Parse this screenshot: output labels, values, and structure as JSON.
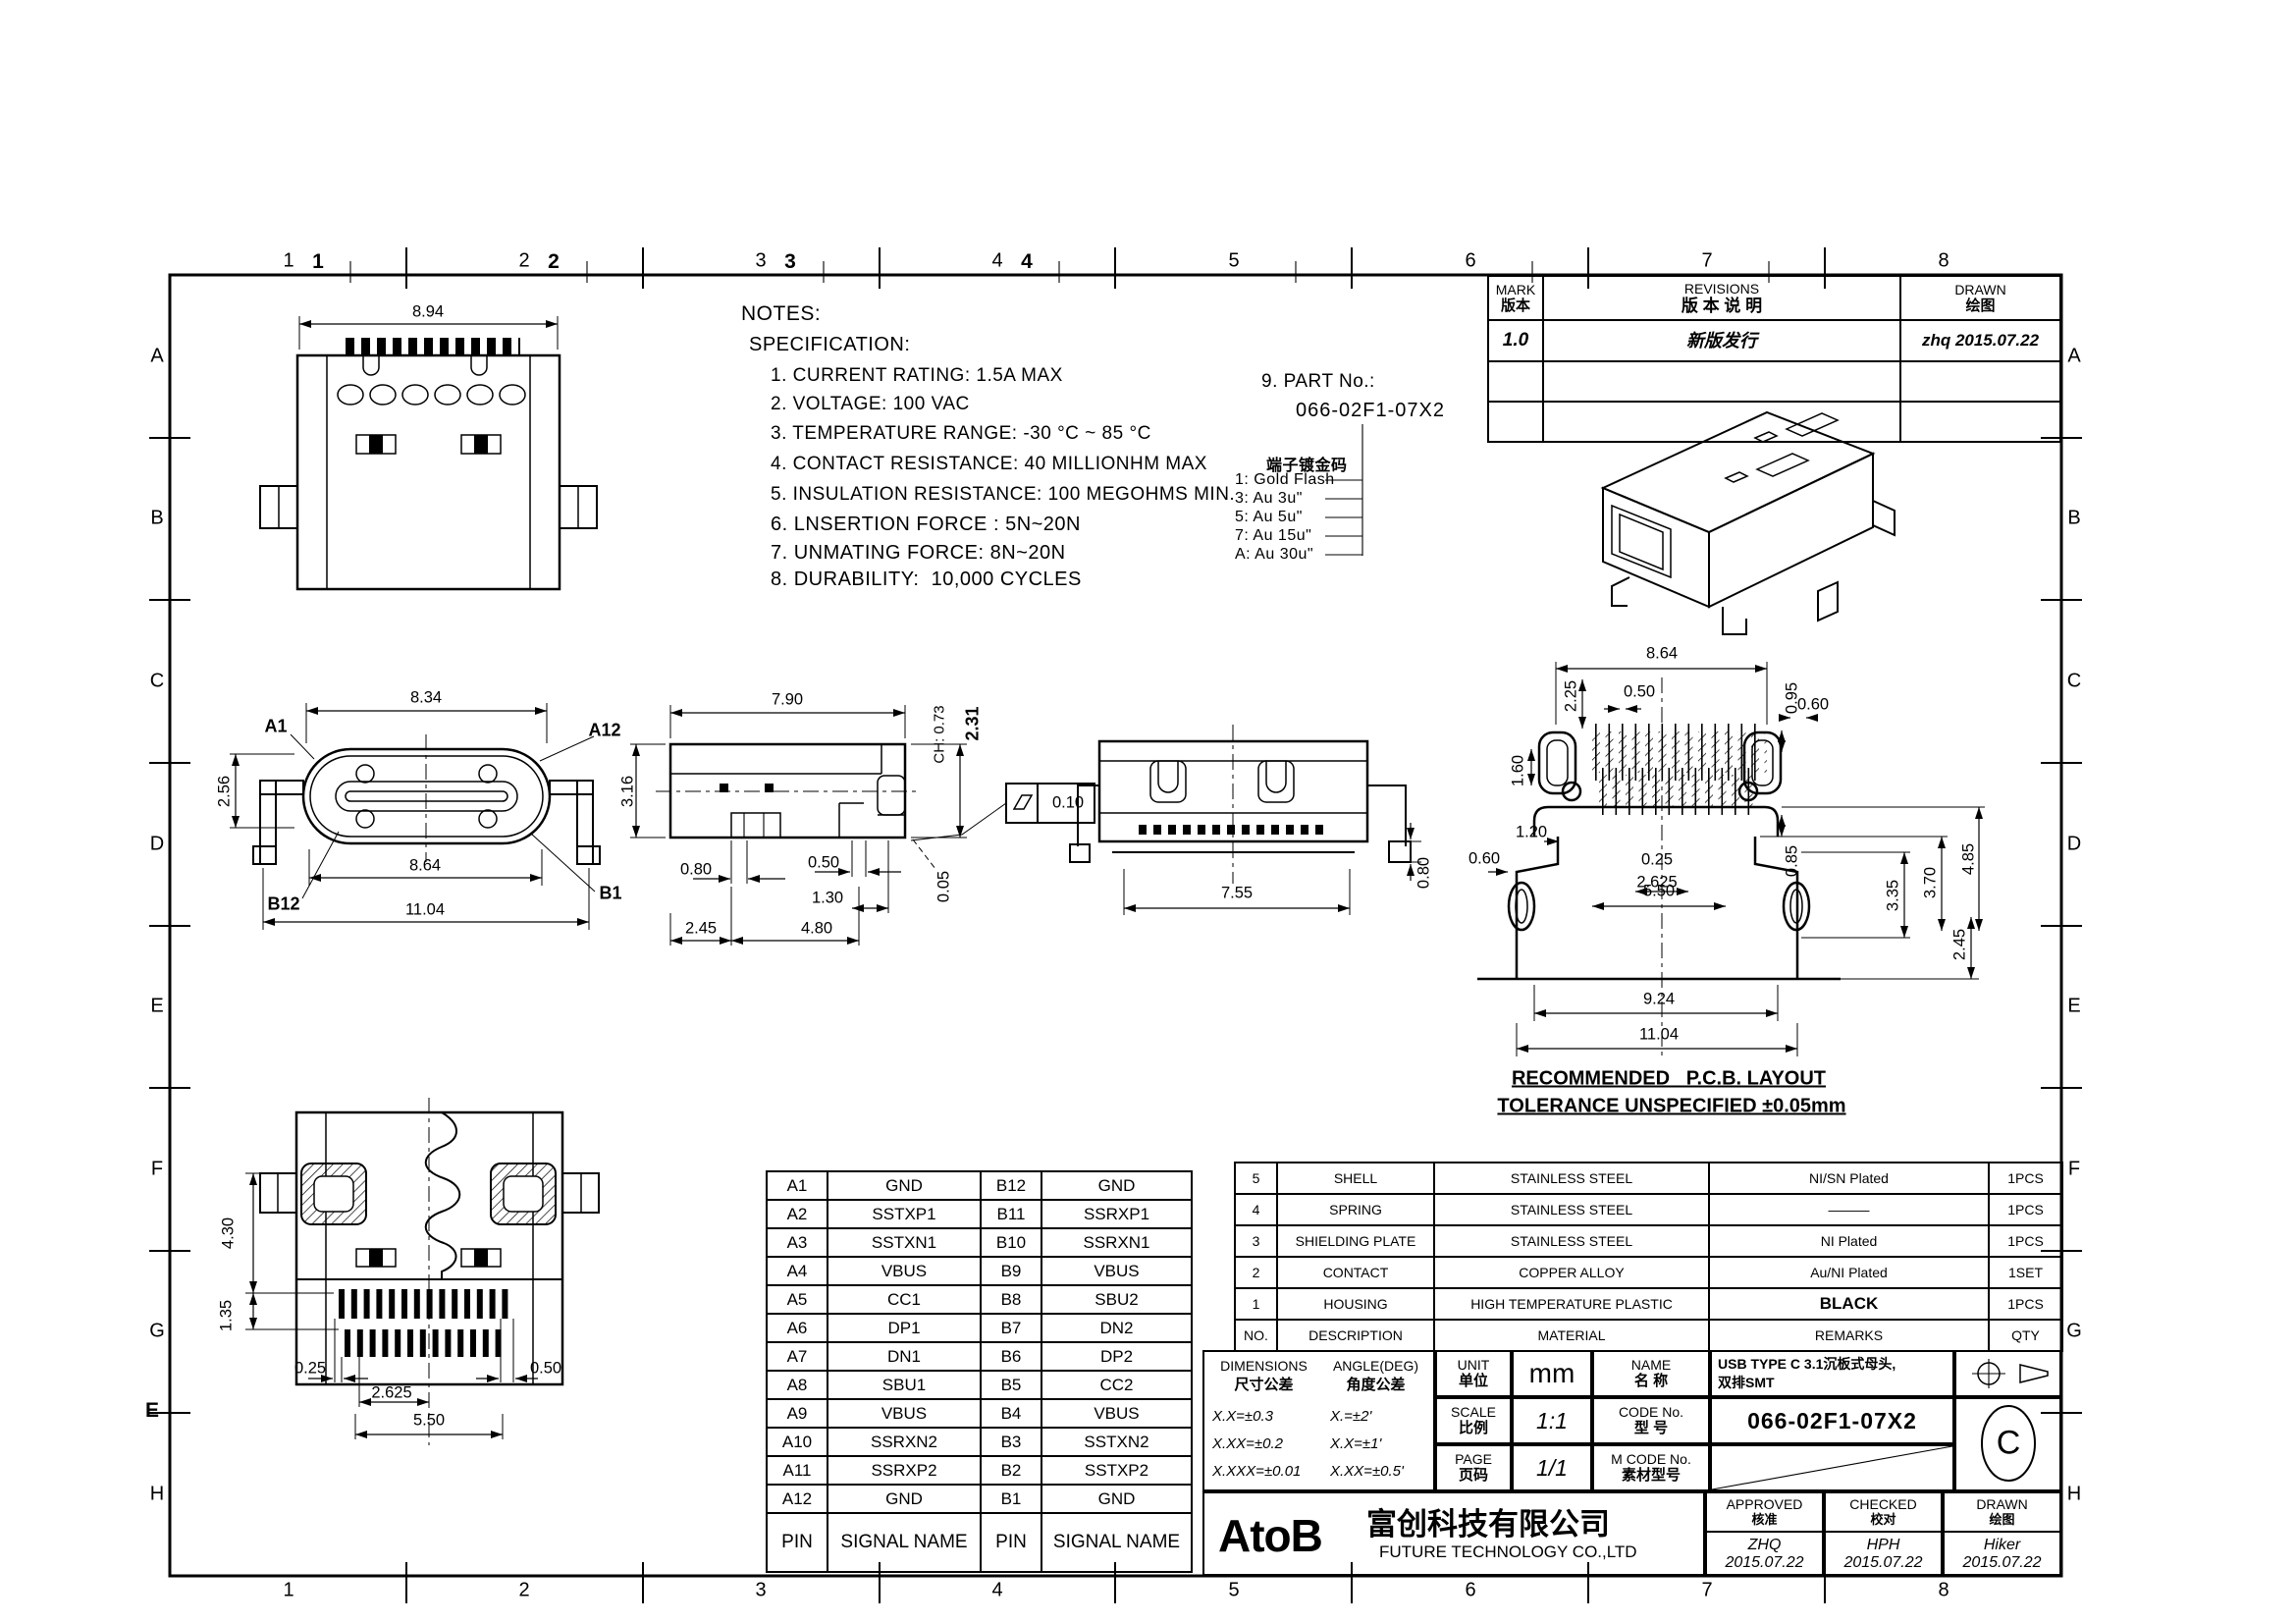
{
  "frame": {
    "columns": [
      "1",
      "2",
      "3",
      "4",
      "5",
      "6",
      "7",
      "8"
    ],
    "columns_bold": [
      "1",
      "2",
      "3",
      "4"
    ],
    "rows": [
      "A",
      "B",
      "C",
      "D",
      "E",
      "F",
      "G",
      "H"
    ],
    "stray_row_label": "E"
  },
  "revisions": {
    "mark_en": "MARK",
    "mark_cn": "版本",
    "title_en": "REVISIONS",
    "title_cn": "版  本  说  明",
    "drawn_en": "DRAWN",
    "drawn_cn": "绘图",
    "rows": [
      {
        "mark": "1.0",
        "desc": "新版发行",
        "drawn": "zhq  2015.07.22"
      }
    ]
  },
  "notes": {
    "title": "NOTES:",
    "subtitle": "SPECIFICATION:",
    "items": [
      "1. CURRENT RATING: 1.5A MAX",
      "2. VOLTAGE: 100 VAC",
      "3. TEMPERATURE RANGE: -30 °C ~ 85 °C",
      "4. CONTACT RESISTANCE: 40 MILLIONHM MAX",
      "5. INSULATION RESISTANCE: 100 MEGOHMS MIN.",
      "6. LNSERTION FORCE : 5N~20N",
      "7. UNMATING FORCE: 8N~20N",
      "8. DURABILITY:  10,000 CYCLES"
    ]
  },
  "part_no": {
    "label": "9. PART No.:",
    "value": "066-02F1-07X2",
    "plating_title": "端子镀金码",
    "options": [
      "1: Gold Flash",
      "3: Au 3u\"",
      "5: Au 5u\"",
      "7: Au 15u\"",
      "A: Au 30u\""
    ]
  },
  "views": {
    "rear_top": {
      "w": "8.94"
    },
    "front": {
      "top": "8.34",
      "height": "2.56",
      "inner_w": "8.64",
      "outer_w": "11.04",
      "pin_a1": "A1",
      "pin_a12": "A12",
      "pin_b12": "B12",
      "pin_b1": "B1",
      "side_h": "3.16"
    },
    "side": {
      "top": "7.90",
      "ch": "CH: 0.73",
      "total_h": "2.31",
      "foot_w": "0.80",
      "gap": "0.50",
      "lead": "1.30",
      "left": "2.45",
      "right": "4.80",
      "standoff": "0.05",
      "flatness": "0.10"
    },
    "rear": {
      "w": "7.55",
      "h": "0.80"
    },
    "bottom": {
      "h1": "4.30",
      "h2": "1.35",
      "p1": "0.25",
      "p2": "2.625",
      "p3": "0.50",
      "p4": "5.50"
    },
    "pcb": {
      "w": "8.64",
      "a": "2.25",
      "b": "0.50",
      "c": "0.95",
      "d": "0.60",
      "e": "1.60",
      "f": "1.20",
      "g": "0.25",
      "h": "2.625",
      "i": "0.85",
      "j": "3.35",
      "k": "3.70",
      "l": "4.85",
      "m": "0.60",
      "n": "5.50",
      "o": "2.45",
      "p": "9.24",
      "q": "11.04",
      "note1": "RECOMMENDED   P.C.B. LAYOUT",
      "note2": "TOLERANCE UNSPECIFIED ±0.05mm"
    }
  },
  "pin_table": {
    "header": {
      "pin": "PIN",
      "signal": "SIGNAL NAME"
    },
    "rows": [
      {
        "pa": "A1",
        "sa": "GND",
        "pb": "B12",
        "sb": "GND"
      },
      {
        "pa": "A2",
        "sa": "SSTXP1",
        "pb": "B11",
        "sb": "SSRXP1"
      },
      {
        "pa": "A3",
        "sa": "SSTXN1",
        "pb": "B10",
        "sb": "SSRXN1"
      },
      {
        "pa": "A4",
        "sa": "VBUS",
        "pb": "B9",
        "sb": "VBUS"
      },
      {
        "pa": "A5",
        "sa": "CC1",
        "pb": "B8",
        "sb": "SBU2"
      },
      {
        "pa": "A6",
        "sa": "DP1",
        "pb": "B7",
        "sb": "DN2"
      },
      {
        "pa": "A7",
        "sa": "DN1",
        "pb": "B6",
        "sb": "DP2"
      },
      {
        "pa": "A8",
        "sa": "SBU1",
        "pb": "B5",
        "sb": "CC2"
      },
      {
        "pa": "A9",
        "sa": "VBUS",
        "pb": "B4",
        "sb": "VBUS"
      },
      {
        "pa": "A10",
        "sa": "SSRXN2",
        "pb": "B3",
        "sb": "SSTXN2"
      },
      {
        "pa": "A11",
        "sa": "SSRXP2",
        "pb": "B2",
        "sb": "SSTXP2"
      },
      {
        "pa": "A12",
        "sa": "GND",
        "pb": "B1",
        "sb": "GND"
      }
    ]
  },
  "bom": {
    "header": {
      "no": "NO.",
      "desc": "DESCRIPTION",
      "mat": "MATERIAL",
      "rem": "REMARKS",
      "qty": "QTY"
    },
    "rows": [
      {
        "no": "5",
        "desc": "SHELL",
        "mat": "STAINLESS STEEL",
        "rem": "NI/SN  Plated",
        "qty": "1PCS"
      },
      {
        "no": "4",
        "desc": "SPRING",
        "mat": "STAINLESS STEEL",
        "rem": "———",
        "qty": "1PCS"
      },
      {
        "no": "3",
        "desc": "SHIELDING PLATE",
        "mat": "STAINLESS STEEL",
        "rem": "NI  Plated",
        "qty": "1PCS"
      },
      {
        "no": "2",
        "desc": "CONTACT",
        "mat": "COPPER ALLOY",
        "rem": "Au/NI Plated",
        "qty": "1SET"
      },
      {
        "no": "1",
        "desc": "HOUSING",
        "mat": "HIGH TEMPERATURE PLASTIC",
        "rem": "BLACK",
        "qty": "1PCS"
      }
    ]
  },
  "title_block": {
    "tol": {
      "dim_en": "DIMENSIONS",
      "dim_cn": "尺寸公差",
      "ang_en": "ANGLE(DEG)",
      "ang_cn": "角度公差",
      "dims": [
        "X.X=±0.3",
        "X.XX=±0.2",
        "X.XXX=±0.01"
      ],
      "angles": [
        "X.=±2'",
        "X.X=±1'",
        "X.XX=±0.5'"
      ]
    },
    "unit_en": "UNIT",
    "unit_cn": "单位",
    "unit_val": "mm",
    "scale_en": "SCALE",
    "scale_cn": "比例",
    "scale_val": "1:1",
    "page_en": "PAGE",
    "page_cn": "页码",
    "page_val": "1/1",
    "name_en": "NAME",
    "name_cn": "名  称",
    "name_val1": "USB TYPE C 3.1沉板式母头,",
    "name_val2": "双排SMT",
    "code_en": "CODE No.",
    "code_cn": "型  号",
    "code_val": "066-02F1-07X2",
    "mcode_en": "M CODE No.",
    "mcode_cn": "素材型号",
    "rev_letter": "C",
    "logo": "AtoB",
    "company_cn": "富创科技有限公司",
    "company_en": "FUTURE  TECHNOLOGY  CO.,LTD",
    "approved_en": "APPROVED",
    "approved_cn": "核准",
    "approved_name": "ZHQ",
    "approved_date": "2015.07.22",
    "checked_en": "CHECKED",
    "checked_cn": "校对",
    "checked_name": "HPH",
    "checked_date": "2015.07.22",
    "drawn_en": "DRAWN",
    "drawn_cn": "绘图",
    "drawn_name": "Hiker",
    "drawn_date": "2015.07.22"
  }
}
